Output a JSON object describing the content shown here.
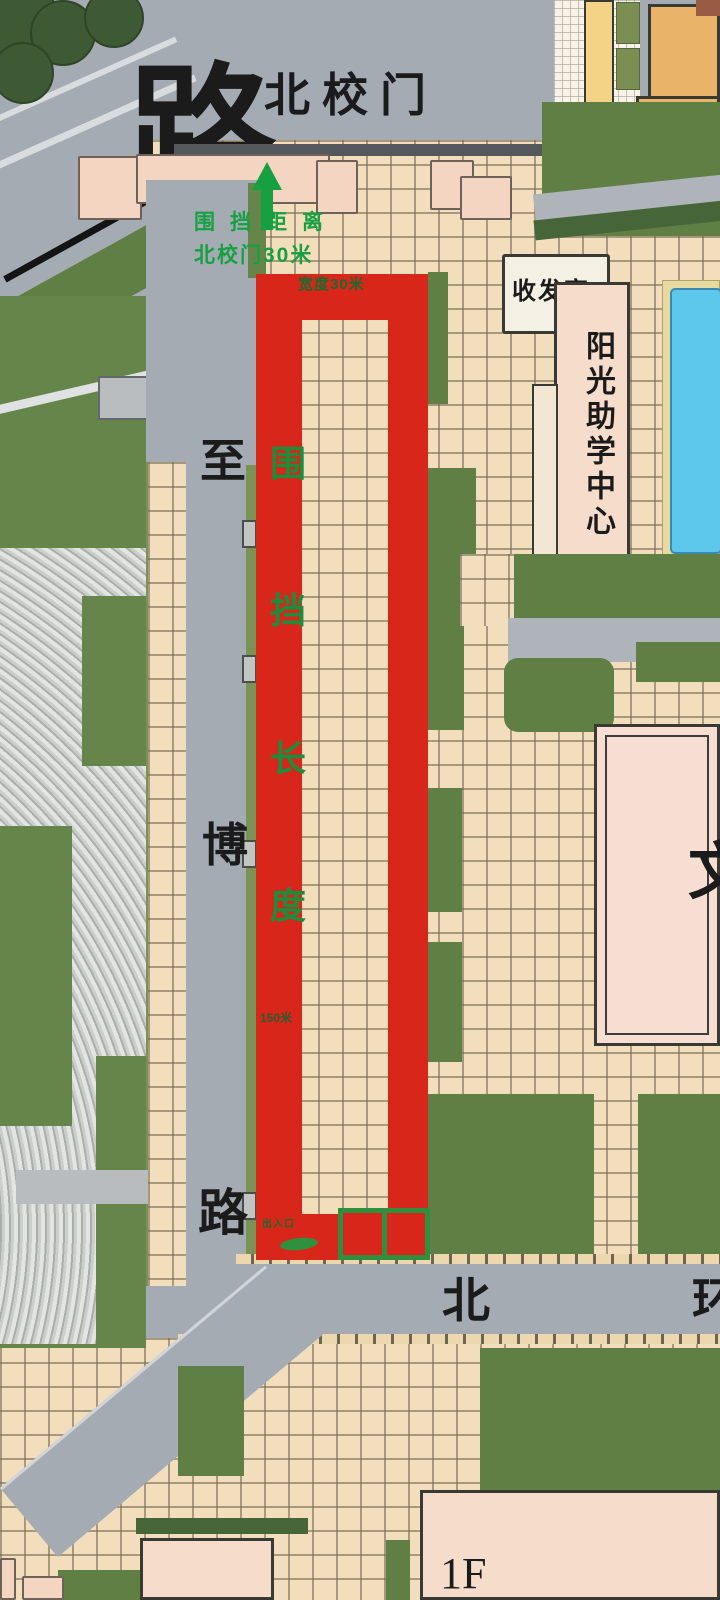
{
  "map": {
    "region_labels": {
      "top_left_road": "路",
      "north_gate": "北校门",
      "mail_room": "收发室",
      "aid_center": "阳光助学中心",
      "building_wen": "文",
      "building_floor": "1F"
    },
    "vertical_road": {
      "chars": [
        "至",
        "博",
        "路"
      ]
    },
    "bottom_road": {
      "chars": [
        "北",
        "环"
      ]
    },
    "annotation": {
      "line1": "围挡距离",
      "line2": "北校门30米",
      "width_note": "宽度30米",
      "fence_chars": [
        "围",
        "挡",
        "长",
        "度"
      ],
      "length_note": "150米",
      "gate_note": "出入口"
    },
    "colors": {
      "fence_red": "#d8261b",
      "annotation_green": "#17a042",
      "lawn_green": "#5f7f45",
      "road_gray": "#a4abb3",
      "tile_tan": "#f2debc",
      "pool_blue": "#5ec7ec",
      "building_pink": "#f6ddcb",
      "building_orange": "#e9b469"
    }
  }
}
